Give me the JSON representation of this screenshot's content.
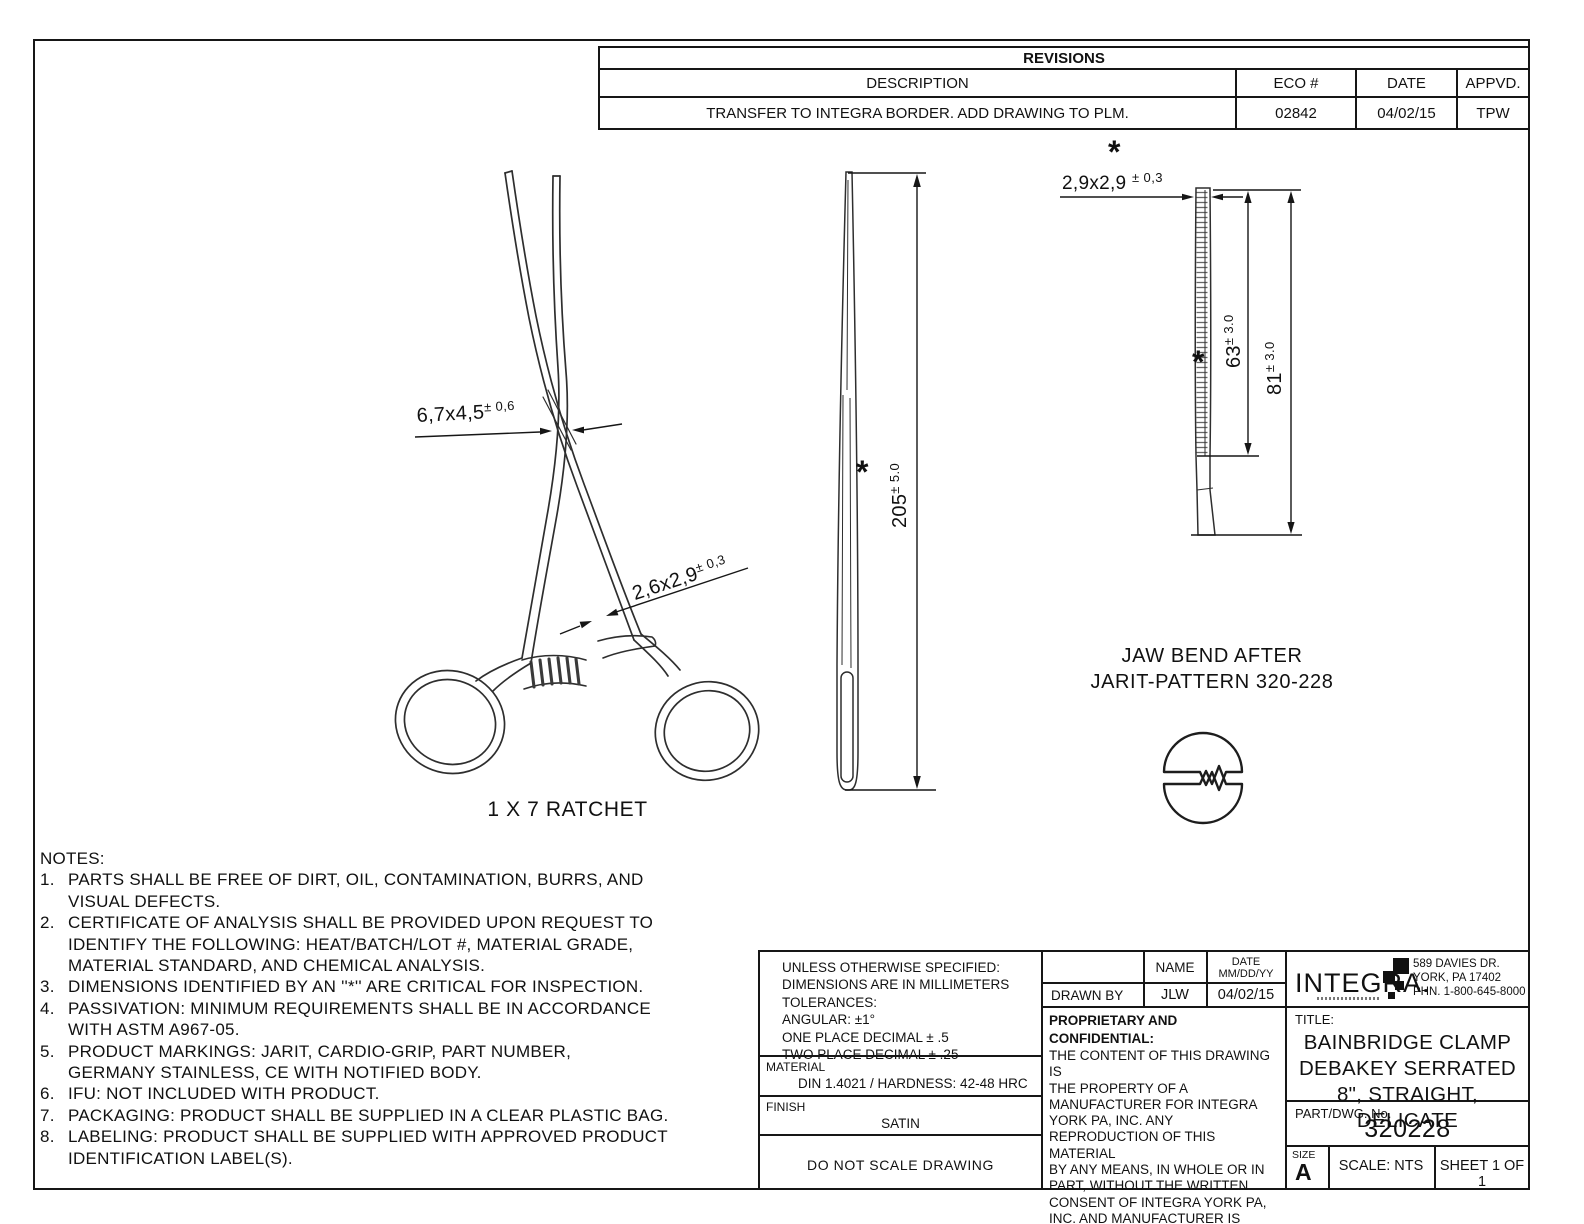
{
  "revisions": {
    "title": "REVISIONS",
    "headers": [
      "DESCRIPTION",
      "ECO #",
      "DATE",
      "APPVD."
    ],
    "row": [
      "TRANSFER TO INTEGRA BORDER. ADD DRAWING TO PLM.",
      "02842",
      "04/02/15",
      "TPW"
    ]
  },
  "front_view": {
    "dim_box": {
      "main": "6,7x4,5",
      "tol": "± 0,6"
    },
    "dim_shank": {
      "main": "2,6x2,9",
      "tol": "± 0,3"
    },
    "caption": "1 X 7 RATCHET"
  },
  "side_view": {
    "dim_length": {
      "main": "205",
      "tol": "± 5.0"
    },
    "asterisk": "*"
  },
  "jaw_view": {
    "dim_tip": {
      "main": "2,9x2,9 ",
      "tol": "± 0,3"
    },
    "asterisk_top": "*",
    "dim_serration": {
      "main": "63",
      "tol": "± 3.0"
    },
    "asterisk_mid": "*",
    "dim_overall": {
      "main": "81",
      "tol": "± 3.0"
    },
    "note_line1": "JAW BEND AFTER",
    "note_line2": "JARIT-PATTERN 320-228"
  },
  "notes": {
    "heading": "NOTES:",
    "items": [
      {
        "num": "1.",
        "text": "PARTS SHALL BE FREE OF DIRT, OIL, CONTAMINATION, BURRS, AND\nVISUAL DEFECTS."
      },
      {
        "num": "2.",
        "text": "CERTIFICATE OF ANALYSIS SHALL BE PROVIDED UPON REQUEST TO\nIDENTIFY THE FOLLOWING: HEAT/BATCH/LOT #, MATERIAL GRADE,\nMATERIAL STANDARD, AND CHEMICAL ANALYSIS."
      },
      {
        "num": "3.",
        "text": "DIMENSIONS IDENTIFIED BY AN ''*'' ARE CRITICAL FOR INSPECTION."
      },
      {
        "num": "4.",
        "text": "PASSIVATION: MINIMUM REQUIREMENTS SHALL BE IN ACCORDANCE\nWITH ASTM A967-05."
      },
      {
        "num": "5.",
        "text": "PRODUCT MARKINGS: JARIT, CARDIO-GRIP, PART NUMBER,\nGERMANY STAINLESS, CE WITH NOTIFIED BODY."
      },
      {
        "num": "6.",
        "text": "IFU: NOT INCLUDED WITH PRODUCT."
      },
      {
        "num": "7.",
        "text": "PACKAGING: PRODUCT SHALL BE SUPPLIED IN A CLEAR PLASTIC BAG."
      },
      {
        "num": "8.",
        "text": "LABELING: PRODUCT SHALL BE SUPPLIED WITH APPROVED PRODUCT\nIDENTIFICATION LABEL(S)."
      }
    ]
  },
  "title_block": {
    "tolerances": "UNLESS OTHERWISE SPECIFIED:\nDIMENSIONS ARE IN MILLIMETERS\nTOLERANCES:\nANGULAR: ±1°\nONE PLACE DECIMAL ± .5\nTWO PLACE DECIMAL ± .25",
    "material_label": "MATERIAL",
    "material_value": "DIN 1.4021 / HARDNESS: 42-48 HRC",
    "finish_label": "FINISH",
    "finish_value": "SATIN",
    "no_scale": "DO NOT SCALE DRAWING",
    "name_header": "NAME",
    "date_header": "DATE\nMM/DD/YY",
    "drawn_by_label": "DRAWN BY",
    "drawn_by_name": "JLW",
    "drawn_by_date": "04/02/15",
    "proprietary_heading": "PROPRIETARY AND CONFIDENTIAL:",
    "proprietary_body": "THE CONTENT OF THIS DRAWING IS\nTHE PROPERTY OF A\nMANUFACTURER FOR INTEGRA\nYORK PA, INC. ANY\nREPRODUCTION OF THIS MATERIAL\nBY ANY MEANS, IN WHOLE OR IN\nPART, WITHOUT THE WRITTEN\nCONSENT OF INTEGRA YORK PA,\nINC. AND MANUFACTURER IS\nPROHIBITED.",
    "company_logo": "INTEGRA.",
    "company_address": "589 DAVIES DR.\nYORK, PA 17402\nPHN. 1-800-645-8000",
    "title_label": "TITLE:",
    "title_line1": "BAINBRIDGE CLAMP",
    "title_line2": "DEBAKEY SERRATED",
    "title_line3": "8\", STRAIGHT, DELICATE",
    "part_label": "PART/DWG. No.",
    "part_number": "320228",
    "size_label": "SIZE",
    "size_value": "A",
    "scale": "SCALE: NTS",
    "sheet": "SHEET 1 OF 1"
  }
}
